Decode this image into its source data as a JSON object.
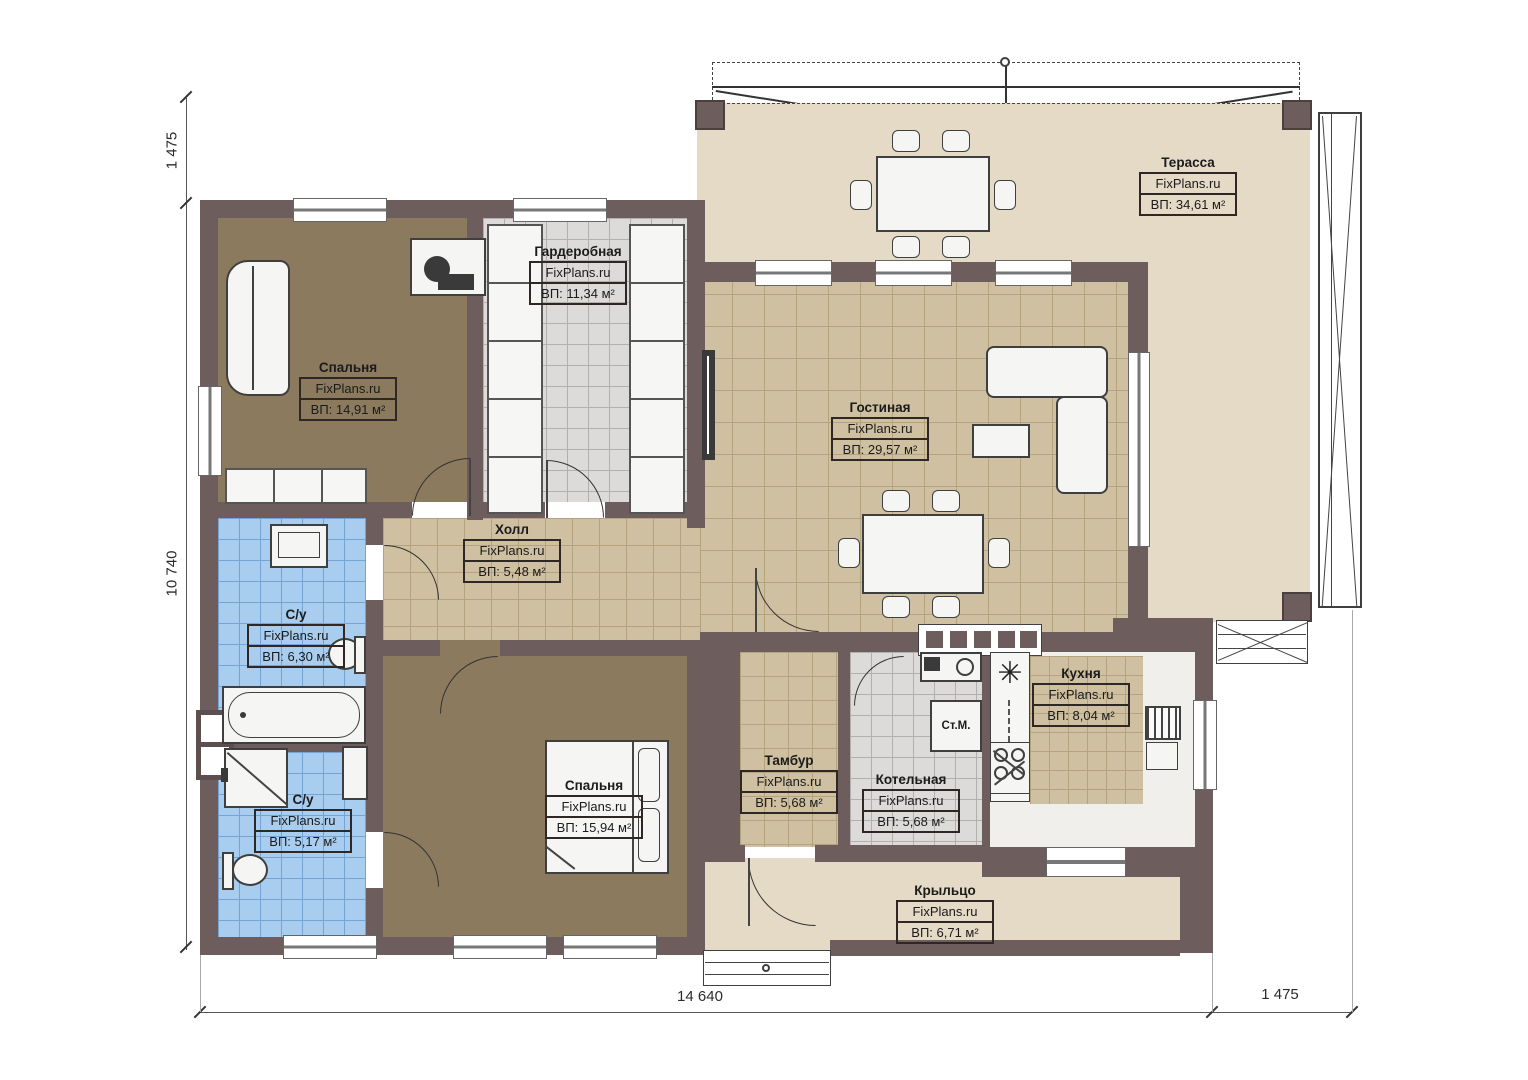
{
  "brand": "FixPlans.ru",
  "dimensions": {
    "top_left": "1 475",
    "left": "10 740",
    "bottom": "14 640",
    "bottom_right": "1 475"
  },
  "rooms": {
    "terrace": {
      "name": "Терасса",
      "brand": "FixPlans.ru",
      "area": "ВП: 34,61 м²"
    },
    "wardrobe": {
      "name": "Гардеробная",
      "brand": "FixPlans.ru",
      "area": "ВП: 11,34 м²"
    },
    "bedroom1": {
      "name": "Спальня",
      "brand": "FixPlans.ru",
      "area": "ВП: 14,91 м²"
    },
    "living": {
      "name": "Гостиная",
      "brand": "FixPlans.ru",
      "area": "ВП: 29,57 м²"
    },
    "hall": {
      "name": "Холл",
      "brand": "FixPlans.ru",
      "area": "ВП: 5,48 м²"
    },
    "bath_top": {
      "name": "С/у",
      "brand": "FixPlans.ru",
      "area": "ВП: 6,30 м²"
    },
    "bath_bottom": {
      "name": "С/у",
      "brand": "FixPlans.ru",
      "area": "ВП: 5,17 м²"
    },
    "bedroom2": {
      "name": "Спальня",
      "brand": "FixPlans.ru",
      "area": "ВП: 15,94 м²"
    },
    "tambur": {
      "name": "Тамбур",
      "brand": "FixPlans.ru",
      "area": "ВП: 5,68 м²"
    },
    "boiler": {
      "name": "Котельная",
      "brand": "FixPlans.ru",
      "area": "ВП: 5,68 м²"
    },
    "kitchen": {
      "name": "Кухня",
      "brand": "FixPlans.ru",
      "area": "ВП: 8,04 м²"
    },
    "porch": {
      "name": "Крыльцо",
      "brand": "FixPlans.ru",
      "area": "ВП: 6,71 м²"
    }
  },
  "annotations": {
    "washing_machine": "Ст.М.",
    "stove_symbol": "✳"
  },
  "colors": {
    "wall": "#6d5d5d",
    "terrace_floor": "#e4dac6",
    "tan_floor": "#cec0a0",
    "brown_floor": "#8b7a5e",
    "blue_floor": "#a9cdee",
    "gray_floor": "#dcdbd9"
  }
}
